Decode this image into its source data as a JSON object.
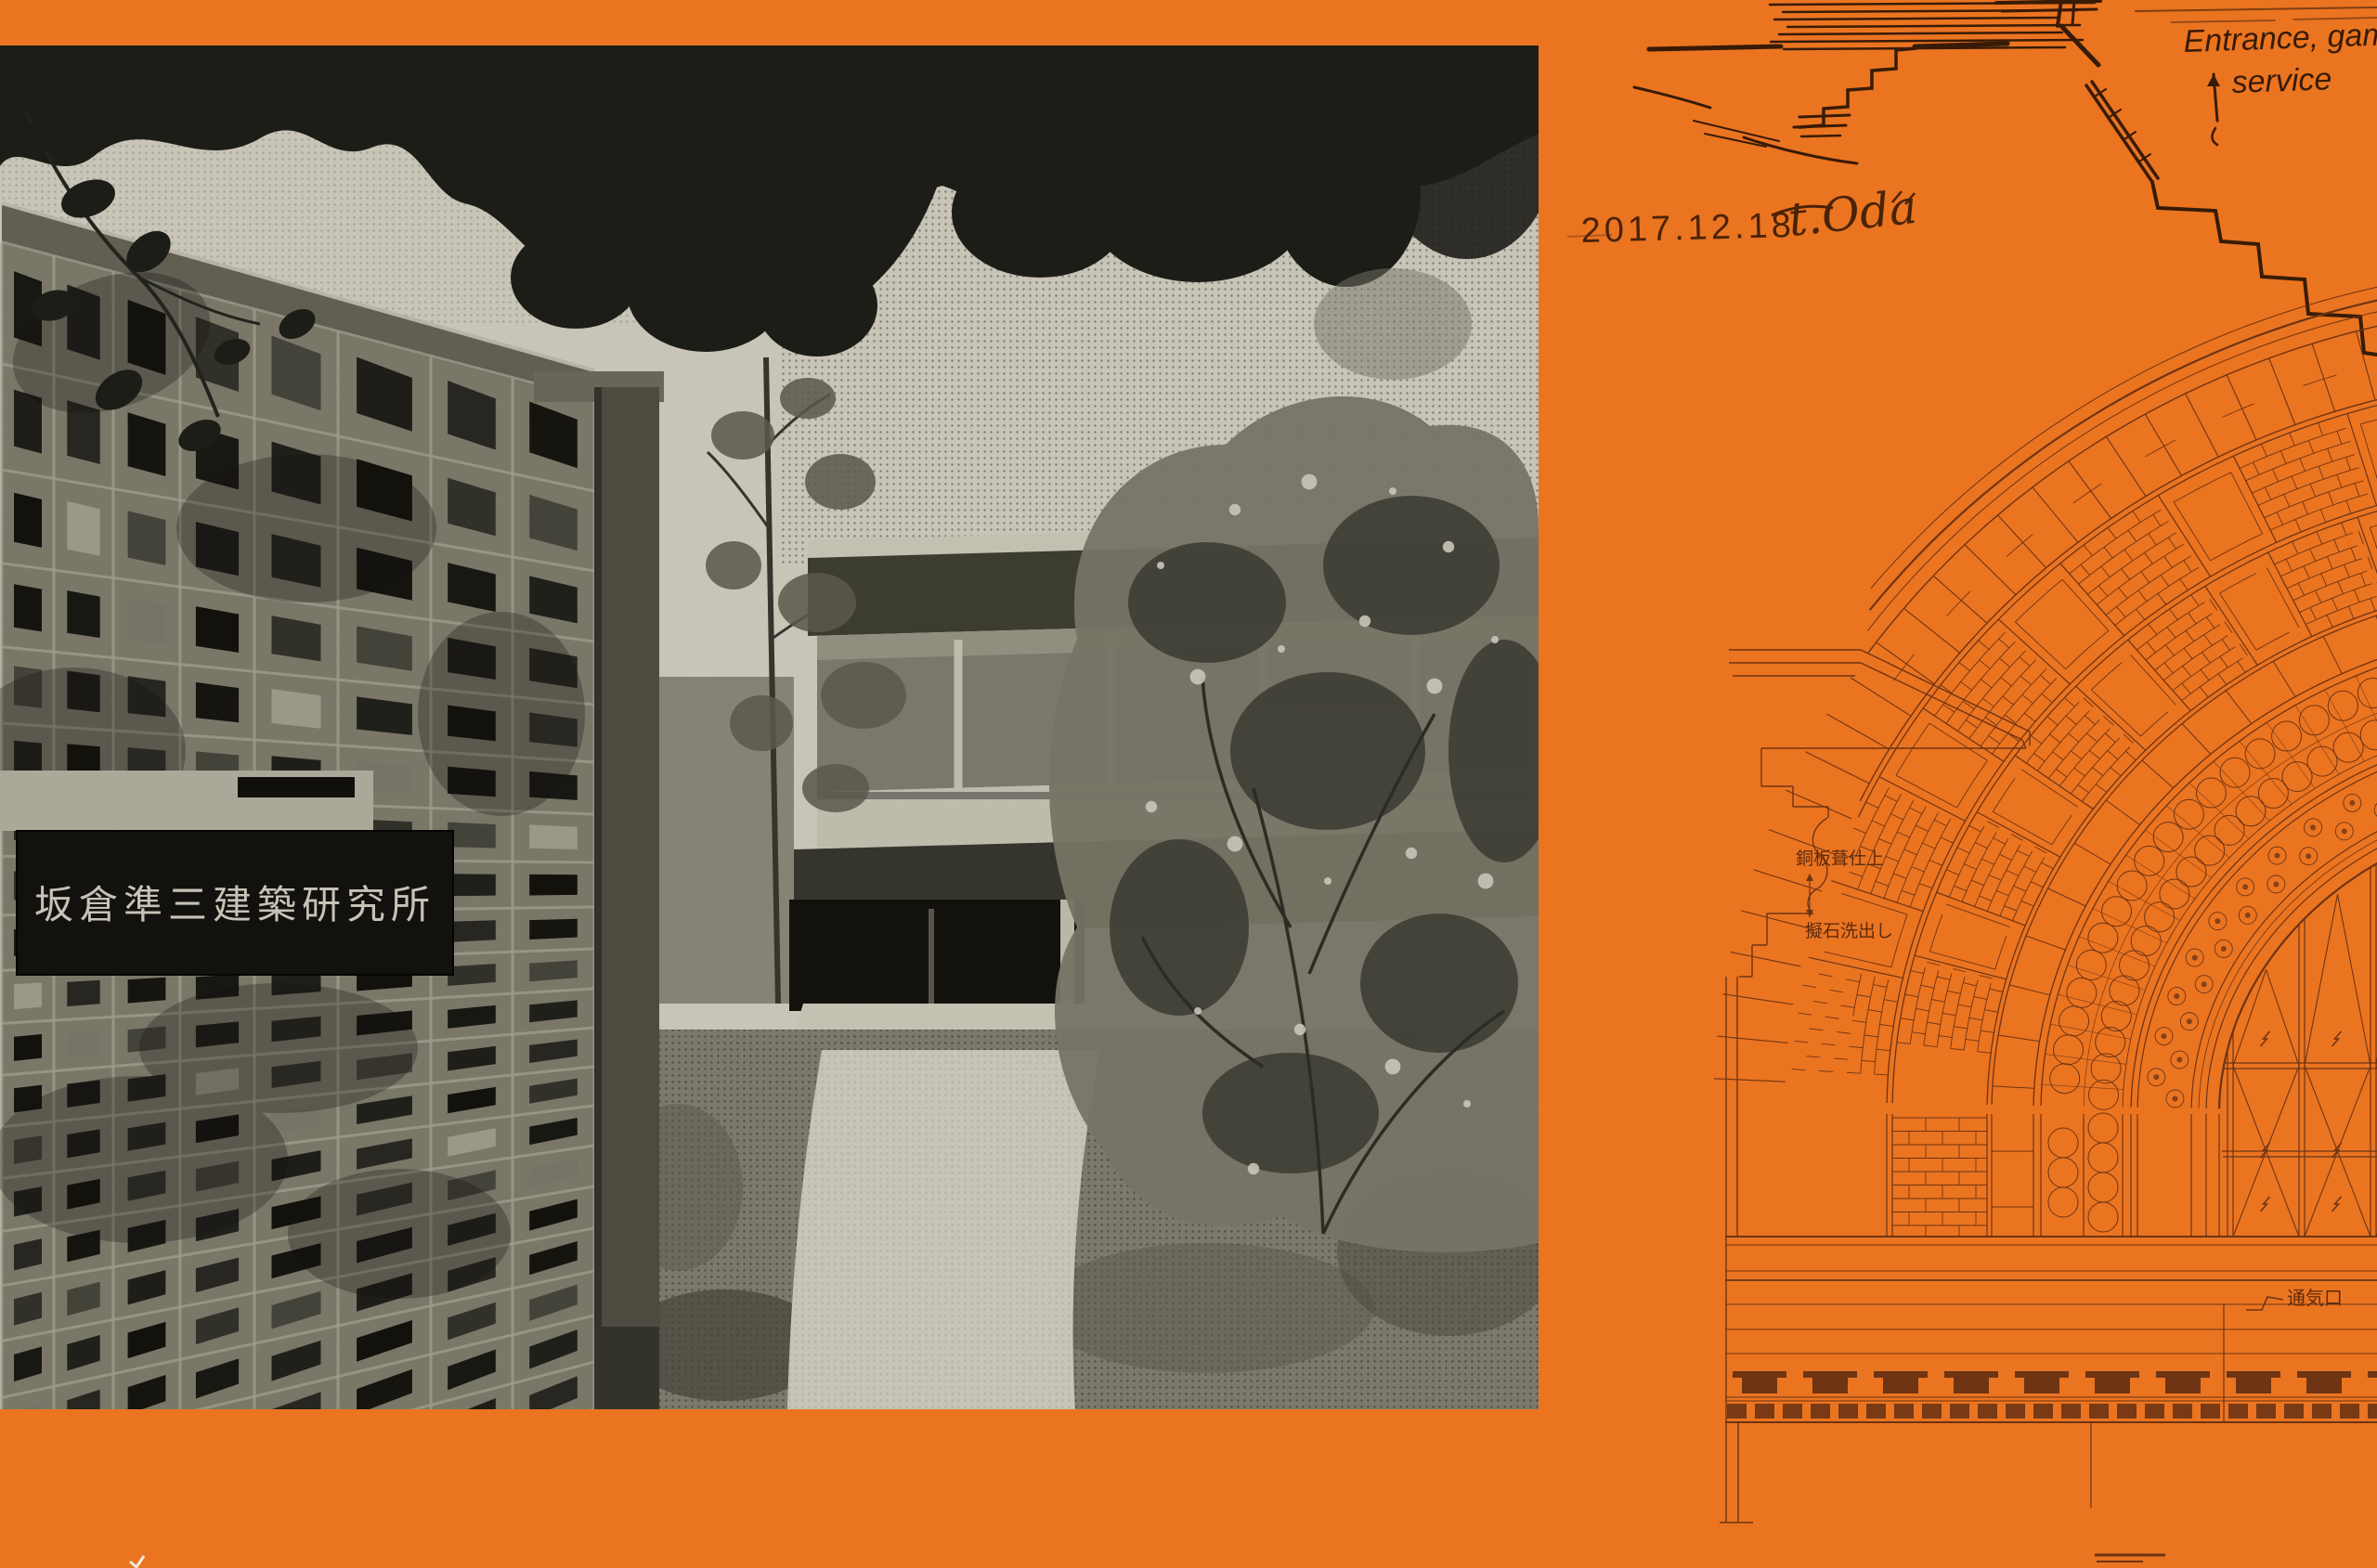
{
  "poster": {
    "background_color": "#EB7421",
    "drawing_ink_color": "#6E3413",
    "sketch_ink_color": "#381B06"
  },
  "photo": {
    "sign_text": "坂倉準三建築研究所"
  },
  "annotations": {
    "date": "2017.12.18",
    "signature": "t.Oda",
    "note_line1": "Entrance, game",
    "note_line2": "service"
  },
  "drawing": {
    "label_copper_roof": "銅板葺仕上",
    "label_cast_stone": "擬石洗出し",
    "label_vent": "通気口"
  }
}
